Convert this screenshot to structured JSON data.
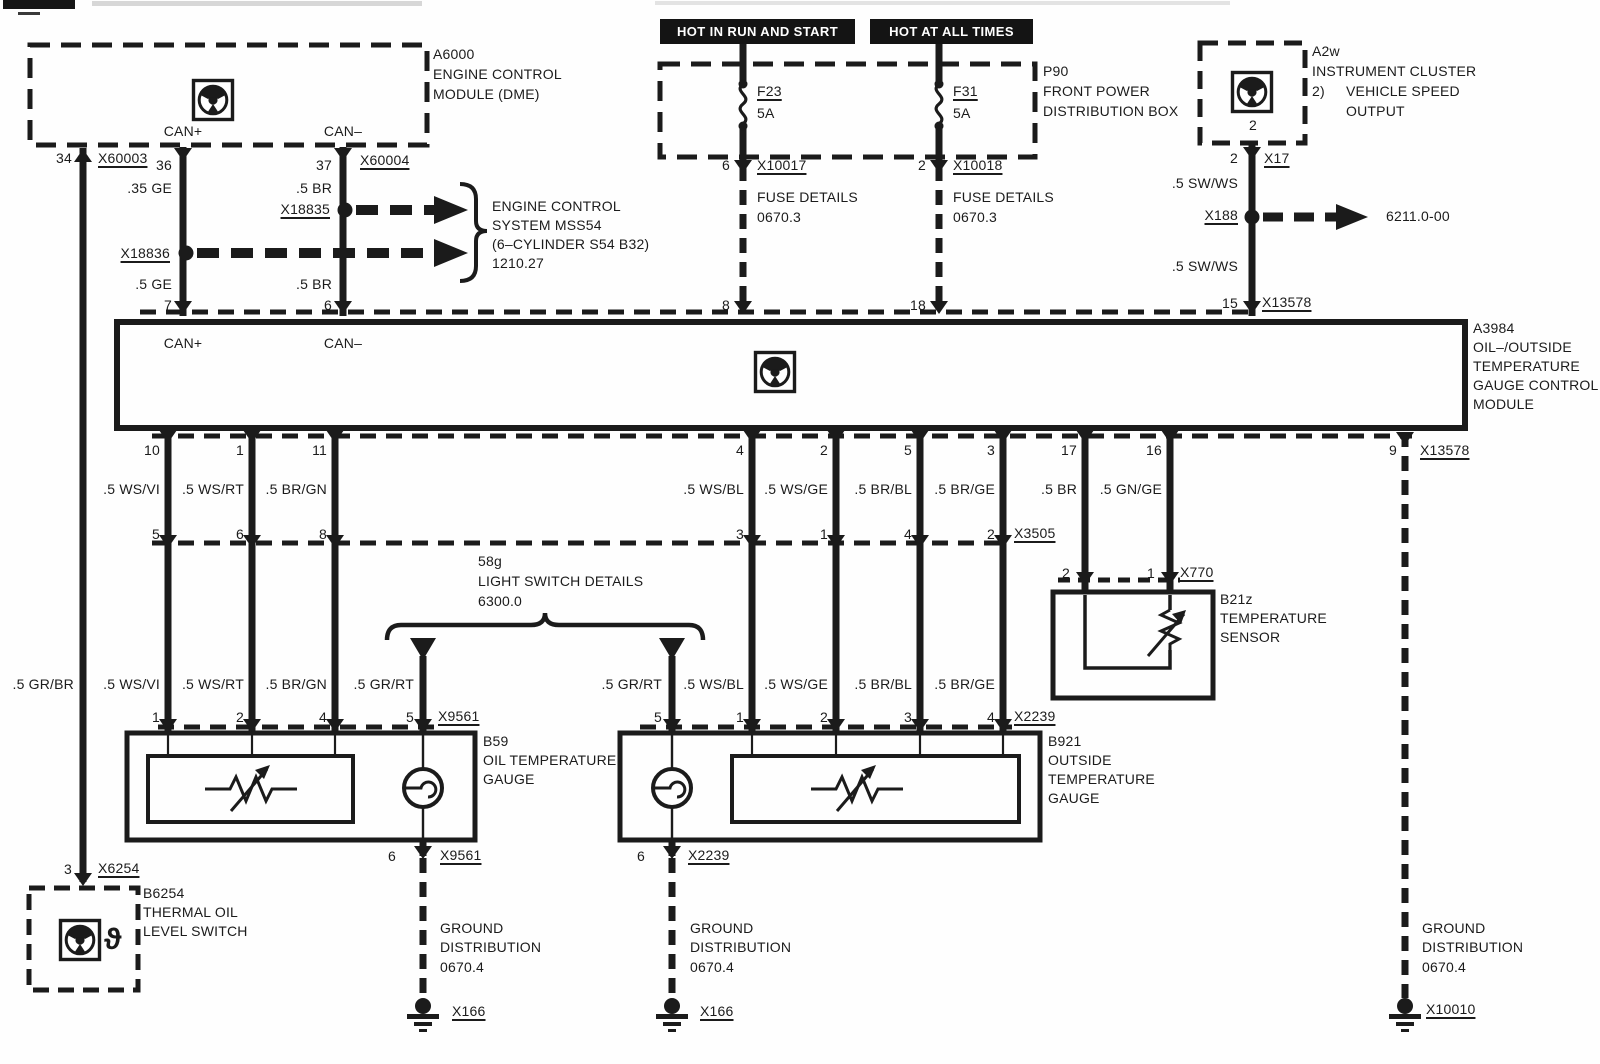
{
  "colors": {
    "line": "#1b1b1b",
    "banner_bg": "#141414",
    "banner_text": "#ffffff",
    "paper": "#fefefe"
  },
  "banners": {
    "b1": "HOT IN RUN AND START",
    "b2": "HOT AT ALL TIMES"
  },
  "icons": {
    "control_module": "steering-wheel-icon",
    "thermal_switch": "theta-glyph",
    "fuse": "fuse-squiggle",
    "lamp": "bulb-circle",
    "ground": "chassis-ground"
  },
  "texts": [
    {
      "n": "dme-id",
      "t": "A6000",
      "x": 433,
      "y": 47,
      "a": "l"
    },
    {
      "n": "dme-name-1",
      "t": "ENGINE CONTROL",
      "x": 433,
      "y": 67,
      "a": "l"
    },
    {
      "n": "dme-name-2",
      "t": "MODULE (DME)",
      "x": 433,
      "y": 87,
      "a": "l"
    },
    {
      "n": "dme-can-plus",
      "t": "CAN+",
      "x": 183,
      "y": 124,
      "a": "c"
    },
    {
      "n": "dme-can-minus",
      "t": "CAN–",
      "x": 343,
      "y": 124,
      "a": "c"
    },
    {
      "n": "pin-34",
      "t": "34",
      "x": 72,
      "y": 151,
      "a": "r"
    },
    {
      "n": "conn-x60003",
      "t": "X60003",
      "x": 98,
      "y": 151,
      "a": "l",
      "u": true
    },
    {
      "n": "pin-36",
      "t": "36",
      "x": 172,
      "y": 158,
      "a": "r"
    },
    {
      "n": "pin-37",
      "t": "37",
      "x": 332,
      "y": 158,
      "a": "r"
    },
    {
      "n": "conn-x60004",
      "t": "X60004",
      "x": 360,
      "y": 153,
      "a": "l",
      "u": true
    },
    {
      "n": "wire-35-ge",
      "t": ".35 GE",
      "x": 172,
      "y": 181,
      "a": "r"
    },
    {
      "n": "wire-5-br-a",
      "t": ".5 BR",
      "x": 332,
      "y": 181,
      "a": "r"
    },
    {
      "n": "conn-x18835",
      "t": "X18835",
      "x": 330,
      "y": 202,
      "a": "r",
      "u": true
    },
    {
      "n": "mss54-1",
      "t": "ENGINE CONTROL",
      "x": 492,
      "y": 199,
      "a": "l"
    },
    {
      "n": "mss54-2",
      "t": "SYSTEM MSS54",
      "x": 492,
      "y": 218,
      "a": "l"
    },
    {
      "n": "mss54-3",
      "t": "(6–CYLINDER S54 B32)",
      "x": 492,
      "y": 237,
      "a": "l"
    },
    {
      "n": "mss54-4",
      "t": "1210.27",
      "x": 492,
      "y": 256,
      "a": "l"
    },
    {
      "n": "conn-x18836",
      "t": "X18836",
      "x": 170,
      "y": 246,
      "a": "r",
      "u": true
    },
    {
      "n": "wire-5-ge",
      "t": ".5 GE",
      "x": 172,
      "y": 277,
      "a": "r"
    },
    {
      "n": "wire-5-br-b",
      "t": ".5 BR",
      "x": 332,
      "y": 277,
      "a": "r"
    },
    {
      "n": "pin-7",
      "t": "7",
      "x": 172,
      "y": 298,
      "a": "r"
    },
    {
      "n": "pin-6",
      "t": "6",
      "x": 332,
      "y": 298,
      "a": "r"
    },
    {
      "n": "p90-id",
      "t": "P90",
      "x": 1043,
      "y": 64,
      "a": "l"
    },
    {
      "n": "p90-name-1",
      "t": "FRONT POWER",
      "x": 1043,
      "y": 84,
      "a": "l"
    },
    {
      "n": "p90-name-2",
      "t": "DISTRIBUTION BOX",
      "x": 1043,
      "y": 104,
      "a": "l"
    },
    {
      "n": "fuse-f23",
      "t": "F23",
      "x": 757,
      "y": 84,
      "a": "l",
      "u": true
    },
    {
      "n": "fuse-f23-amp",
      "t": "5A",
      "x": 757,
      "y": 106,
      "a": "l"
    },
    {
      "n": "fuse-f31",
      "t": "F31",
      "x": 953,
      "y": 84,
      "a": "l",
      "u": true
    },
    {
      "n": "fuse-f31-amp",
      "t": "5A",
      "x": 953,
      "y": 106,
      "a": "l"
    },
    {
      "n": "pin-fuse-6",
      "t": "6",
      "x": 730,
      "y": 158,
      "a": "r"
    },
    {
      "n": "conn-x10017",
      "t": "X10017",
      "x": 757,
      "y": 158,
      "a": "l",
      "u": true
    },
    {
      "n": "pin-fuse-2",
      "t": "2",
      "x": 926,
      "y": 158,
      "a": "r"
    },
    {
      "n": "conn-x10018",
      "t": "X10018",
      "x": 953,
      "y": 158,
      "a": "l",
      "u": true
    },
    {
      "n": "fuse-details-1a",
      "t": "FUSE DETAILS",
      "x": 757,
      "y": 190,
      "a": "l"
    },
    {
      "n": "fuse-details-1b",
      "t": "0670.3",
      "x": 757,
      "y": 210,
      "a": "l"
    },
    {
      "n": "fuse-details-2a",
      "t": "FUSE DETAILS",
      "x": 953,
      "y": 190,
      "a": "l"
    },
    {
      "n": "fuse-details-2b",
      "t": "0670.3",
      "x": 953,
      "y": 210,
      "a": "l"
    },
    {
      "n": "pin-8",
      "t": "8",
      "x": 730,
      "y": 298,
      "a": "r"
    },
    {
      "n": "pin-18",
      "t": "18",
      "x": 926,
      "y": 298,
      "a": "r"
    },
    {
      "n": "a2w-id",
      "t": "A2w",
      "x": 1312,
      "y": 44,
      "a": "l"
    },
    {
      "n": "a2w-name-1",
      "t": "INSTRUMENT CLUSTER",
      "x": 1312,
      "y": 64,
      "a": "l"
    },
    {
      "n": "a2w-note-num",
      "t": "2)",
      "x": 1312,
      "y": 84,
      "a": "l"
    },
    {
      "n": "a2w-name-2",
      "t": "VEHICLE SPEED",
      "x": 1346,
      "y": 84,
      "a": "l"
    },
    {
      "n": "a2w-name-3",
      "t": "OUTPUT",
      "x": 1346,
      "y": 104,
      "a": "l"
    },
    {
      "n": "a2w-icon-pin",
      "t": "2",
      "x": 1253,
      "y": 118,
      "a": "c"
    },
    {
      "n": "pin-a2w-2",
      "t": "2",
      "x": 1238,
      "y": 151,
      "a": "r"
    },
    {
      "n": "conn-x17",
      "t": "X17",
      "x": 1264,
      "y": 151,
      "a": "l",
      "u": true
    },
    {
      "n": "wire-sww-1",
      "t": ".5 SW/WS",
      "x": 1238,
      "y": 176,
      "a": "r"
    },
    {
      "n": "conn-x188",
      "t": "X188",
      "x": 1238,
      "y": 208,
      "a": "r",
      "u": true
    },
    {
      "n": "ref-6211",
      "t": "6211.0-00",
      "x": 1386,
      "y": 209,
      "a": "l"
    },
    {
      "n": "wire-sww-2",
      "t": ".5 SW/WS",
      "x": 1238,
      "y": 259,
      "a": "r"
    },
    {
      "n": "pin-15",
      "t": "15",
      "x": 1238,
      "y": 296,
      "a": "r"
    },
    {
      "n": "conn-x13578-top",
      "t": "X13578",
      "x": 1262,
      "y": 295,
      "a": "l",
      "u": true
    },
    {
      "n": "mod-can-plus",
      "t": "CAN+",
      "x": 183,
      "y": 336,
      "a": "c"
    },
    {
      "n": "mod-can-minus",
      "t": "CAN–",
      "x": 343,
      "y": 336,
      "a": "c"
    },
    {
      "n": "mod-id",
      "t": "A3984",
      "x": 1473,
      "y": 321,
      "a": "l"
    },
    {
      "n": "mod-name-1",
      "t": "OIL–/OUTSIDE",
      "x": 1473,
      "y": 340,
      "a": "l"
    },
    {
      "n": "mod-name-2",
      "t": "TEMPERATURE",
      "x": 1473,
      "y": 359,
      "a": "l"
    },
    {
      "n": "mod-name-3",
      "t": "GAUGE CONTROL",
      "x": 1473,
      "y": 378,
      "a": "l"
    },
    {
      "n": "mod-name-4",
      "t": "MODULE",
      "x": 1473,
      "y": 397,
      "a": "l"
    },
    {
      "n": "pin-10",
      "t": "10",
      "x": 160,
      "y": 443,
      "a": "r"
    },
    {
      "n": "pin-1a",
      "t": "1",
      "x": 244,
      "y": 443,
      "a": "r"
    },
    {
      "n": "pin-11",
      "t": "11",
      "x": 327,
      "y": 443,
      "a": "r"
    },
    {
      "n": "pin-4a",
      "t": "4",
      "x": 744,
      "y": 443,
      "a": "r"
    },
    {
      "n": "pin-2a",
      "t": "2",
      "x": 828,
      "y": 443,
      "a": "r"
    },
    {
      "n": "pin-5a",
      "t": "5",
      "x": 912,
      "y": 443,
      "a": "r"
    },
    {
      "n": "pin-3a",
      "t": "3",
      "x": 995,
      "y": 443,
      "a": "r"
    },
    {
      "n": "pin-17",
      "t": "17",
      "x": 1077,
      "y": 443,
      "a": "r"
    },
    {
      "n": "pin-16",
      "t": "16",
      "x": 1162,
      "y": 443,
      "a": "r"
    },
    {
      "n": "pin-9",
      "t": "9",
      "x": 1397,
      "y": 443,
      "a": "r"
    },
    {
      "n": "conn-x13578-bot",
      "t": "X13578",
      "x": 1420,
      "y": 443,
      "a": "l",
      "u": true
    },
    {
      "n": "wire-ws-vi-1",
      "t": ".5 WS/VI",
      "x": 160,
      "y": 482,
      "a": "r"
    },
    {
      "n": "wire-ws-rt-1",
      "t": ".5 WS/RT",
      "x": 244,
      "y": 482,
      "a": "r"
    },
    {
      "n": "wire-br-gn-1",
      "t": ".5 BR/GN",
      "x": 327,
      "y": 482,
      "a": "r"
    },
    {
      "n": "wire-ws-bl-1",
      "t": ".5 WS/BL",
      "x": 744,
      "y": 482,
      "a": "r"
    },
    {
      "n": "wire-ws-ge-1",
      "t": ".5 WS/GE",
      "x": 828,
      "y": 482,
      "a": "r"
    },
    {
      "n": "wire-br-bl-1",
      "t": ".5 BR/BL",
      "x": 912,
      "y": 482,
      "a": "r"
    },
    {
      "n": "wire-br-ge-1",
      "t": ".5 BR/GE",
      "x": 995,
      "y": 482,
      "a": "r"
    },
    {
      "n": "wire-br",
      "t": ".5 BR",
      "x": 1077,
      "y": 482,
      "a": "r"
    },
    {
      "n": "wire-gn-ge",
      "t": ".5 GN/GE",
      "x": 1162,
      "y": 482,
      "a": "r"
    },
    {
      "n": "pin-5b",
      "t": "5",
      "x": 160,
      "y": 527,
      "a": "r"
    },
    {
      "n": "pin-6b",
      "t": "6",
      "x": 244,
      "y": 527,
      "a": "r"
    },
    {
      "n": "pin-8b",
      "t": "8",
      "x": 327,
      "y": 527,
      "a": "r"
    },
    {
      "n": "pin-3b",
      "t": "3",
      "x": 744,
      "y": 527,
      "a": "r"
    },
    {
      "n": "pin-1b",
      "t": "1",
      "x": 828,
      "y": 527,
      "a": "r"
    },
    {
      "n": "pin-4b",
      "t": "4",
      "x": 912,
      "y": 527,
      "a": "r"
    },
    {
      "n": "pin-2b",
      "t": "2",
      "x": 995,
      "y": 527,
      "a": "r"
    },
    {
      "n": "conn-x3505",
      "t": "X3505",
      "x": 1014,
      "y": 526,
      "a": "l",
      "u": true
    },
    {
      "n": "pin-sens-2",
      "t": "2",
      "x": 1070,
      "y": 566,
      "a": "r"
    },
    {
      "n": "pin-sens-1",
      "t": "1",
      "x": 1155,
      "y": 566,
      "a": "r"
    },
    {
      "n": "conn-x770",
      "t": "X770",
      "x": 1180,
      "y": 565,
      "a": "l",
      "u": true
    },
    {
      "n": "b21z-id",
      "t": "B21z",
      "x": 1220,
      "y": 592,
      "a": "l"
    },
    {
      "n": "b21z-name-1",
      "t": "TEMPERATURE",
      "x": 1220,
      "y": 611,
      "a": "l"
    },
    {
      "n": "b21z-name-2",
      "t": "SENSOR",
      "x": 1220,
      "y": 630,
      "a": "l"
    },
    {
      "n": "ls-id",
      "t": "58g",
      "x": 478,
      "y": 554,
      "a": "l"
    },
    {
      "n": "ls-name",
      "t": "LIGHT SWITCH DETAILS",
      "x": 478,
      "y": 574,
      "a": "l"
    },
    {
      "n": "ls-ref",
      "t": "6300.0",
      "x": 478,
      "y": 594,
      "a": "l"
    },
    {
      "n": "wire-gr-br",
      "t": ".5 GR/BR",
      "x": 74,
      "y": 677,
      "a": "r"
    },
    {
      "n": "wire-ws-vi-2",
      "t": ".5 WS/VI",
      "x": 160,
      "y": 677,
      "a": "r"
    },
    {
      "n": "wire-ws-rt-2",
      "t": ".5 WS/RT",
      "x": 244,
      "y": 677,
      "a": "r"
    },
    {
      "n": "wire-br-gn-2",
      "t": ".5 BR/GN",
      "x": 327,
      "y": 677,
      "a": "r"
    },
    {
      "n": "wire-gr-rt-1",
      "t": ".5 GR/RT",
      "x": 414,
      "y": 677,
      "a": "r"
    },
    {
      "n": "wire-gr-rt-2",
      "t": ".5 GR/RT",
      "x": 662,
      "y": 677,
      "a": "r"
    },
    {
      "n": "wire-ws-bl-2",
      "t": ".5 WS/BL",
      "x": 744,
      "y": 677,
      "a": "r"
    },
    {
      "n": "wire-ws-ge-2",
      "t": ".5 WS/GE",
      "x": 828,
      "y": 677,
      "a": "r"
    },
    {
      "n": "wire-br-bl-2",
      "t": ".5 BR/BL",
      "x": 912,
      "y": 677,
      "a": "r"
    },
    {
      "n": "wire-br-ge-2",
      "t": ".5 BR/GE",
      "x": 995,
      "y": 677,
      "a": "r"
    },
    {
      "n": "pin-b59-1",
      "t": "1",
      "x": 160,
      "y": 710,
      "a": "r"
    },
    {
      "n": "pin-b59-2",
      "t": "2",
      "x": 244,
      "y": 710,
      "a": "r"
    },
    {
      "n": "pin-b59-4",
      "t": "4",
      "x": 327,
      "y": 710,
      "a": "r"
    },
    {
      "n": "pin-b59-5",
      "t": "5",
      "x": 414,
      "y": 710,
      "a": "r"
    },
    {
      "n": "conn-x9561-top",
      "t": "X9561",
      "x": 438,
      "y": 709,
      "a": "l",
      "u": true
    },
    {
      "n": "pin-b921-5",
      "t": "5",
      "x": 662,
      "y": 710,
      "a": "r"
    },
    {
      "n": "pin-b921-1",
      "t": "1",
      "x": 744,
      "y": 710,
      "a": "r"
    },
    {
      "n": "pin-b921-2",
      "t": "2",
      "x": 828,
      "y": 710,
      "a": "r"
    },
    {
      "n": "pin-b921-3",
      "t": "3",
      "x": 912,
      "y": 710,
      "a": "r"
    },
    {
      "n": "pin-b921-4",
      "t": "4",
      "x": 995,
      "y": 710,
      "a": "r"
    },
    {
      "n": "conn-x2239-top",
      "t": "X2239",
      "x": 1014,
      "y": 709,
      "a": "l",
      "u": true
    },
    {
      "n": "b59-id",
      "t": "B59",
      "x": 483,
      "y": 734,
      "a": "l"
    },
    {
      "n": "b59-name-1",
      "t": "OIL TEMPERATURE",
      "x": 483,
      "y": 753,
      "a": "l"
    },
    {
      "n": "b59-name-2",
      "t": "GAUGE",
      "x": 483,
      "y": 772,
      "a": "l"
    },
    {
      "n": "pin-b59-6",
      "t": "6",
      "x": 396,
      "y": 849,
      "a": "r"
    },
    {
      "n": "conn-x9561-bot",
      "t": "X9561",
      "x": 440,
      "y": 848,
      "a": "l",
      "u": true
    },
    {
      "n": "b921-id",
      "t": "B921",
      "x": 1048,
      "y": 734,
      "a": "l"
    },
    {
      "n": "b921-name-1",
      "t": "OUTSIDE",
      "x": 1048,
      "y": 753,
      "a": "l"
    },
    {
      "n": "b921-name-2",
      "t": "TEMPERATURE",
      "x": 1048,
      "y": 772,
      "a": "l"
    },
    {
      "n": "b921-name-3",
      "t": "GAUGE",
      "x": 1048,
      "y": 791,
      "a": "l"
    },
    {
      "n": "pin-b921-6",
      "t": "6",
      "x": 645,
      "y": 849,
      "a": "r"
    },
    {
      "n": "conn-x2239-bot",
      "t": "X2239",
      "x": 688,
      "y": 848,
      "a": "l",
      "u": true
    },
    {
      "n": "gnd1-1",
      "t": "GROUND",
      "x": 440,
      "y": 921,
      "a": "l"
    },
    {
      "n": "gnd1-2",
      "t": "DISTRIBUTION",
      "x": 440,
      "y": 940,
      "a": "l"
    },
    {
      "n": "gnd1-3",
      "t": "0670.4",
      "x": 440,
      "y": 960,
      "a": "l"
    },
    {
      "n": "conn-x166-1",
      "t": "X166",
      "x": 452,
      "y": 1004,
      "a": "l",
      "u": true
    },
    {
      "n": "gnd2-1",
      "t": "GROUND",
      "x": 690,
      "y": 921,
      "a": "l"
    },
    {
      "n": "gnd2-2",
      "t": "DISTRIBUTION",
      "x": 690,
      "y": 940,
      "a": "l"
    },
    {
      "n": "gnd2-3",
      "t": "0670.4",
      "x": 690,
      "y": 960,
      "a": "l"
    },
    {
      "n": "conn-x166-2",
      "t": "X166",
      "x": 700,
      "y": 1004,
      "a": "l",
      "u": true
    },
    {
      "n": "gnd3-1",
      "t": "GROUND",
      "x": 1422,
      "y": 921,
      "a": "l"
    },
    {
      "n": "gnd3-2",
      "t": "DISTRIBUTION",
      "x": 1422,
      "y": 940,
      "a": "l"
    },
    {
      "n": "gnd3-3",
      "t": "0670.4",
      "x": 1422,
      "y": 960,
      "a": "l"
    },
    {
      "n": "conn-x10010",
      "t": "X10010",
      "x": 1426,
      "y": 1002,
      "a": "l",
      "u": true
    },
    {
      "n": "pin-b6254-3",
      "t": "3",
      "x": 72,
      "y": 862,
      "a": "r"
    },
    {
      "n": "conn-x6254",
      "t": "X6254",
      "x": 98,
      "y": 861,
      "a": "l",
      "u": true
    },
    {
      "n": "b6254-id",
      "t": "B6254",
      "x": 143,
      "y": 886,
      "a": "l"
    },
    {
      "n": "b6254-name-1",
      "t": "THERMAL OIL",
      "x": 143,
      "y": 905,
      "a": "l"
    },
    {
      "n": "b6254-name-2",
      "t": "LEVEL SWITCH",
      "x": 143,
      "y": 924,
      "a": "l"
    },
    {
      "n": "thermal-switch-symbol",
      "t": "ϑ",
      "x": 104,
      "y": 923,
      "a": "l",
      "s": 30,
      "b": true
    }
  ]
}
